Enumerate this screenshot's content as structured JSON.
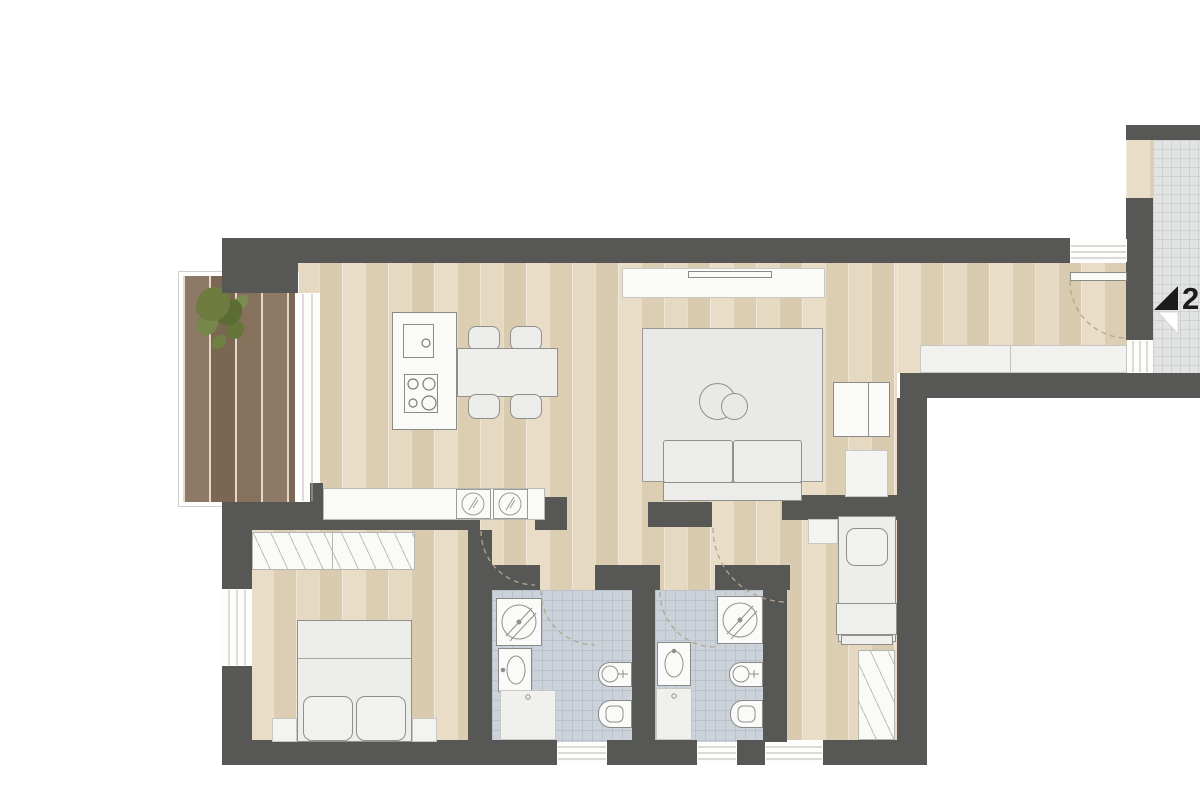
{
  "plan": {
    "type": "apartment-floor-plan",
    "marker": {
      "label": "2P"
    },
    "colors": {
      "wall": "#575756",
      "wood_floor": "#e4d7c0",
      "balcony_deck": "#85705c",
      "bathroom_tile": "#cbd2da",
      "stairwell_tile": "#e2e3e3",
      "rug": "#e9e9e7",
      "furniture_fill": "#ececea",
      "fixture_fill": "#fafaf9",
      "plant": "#6e7d3f",
      "marker_text": "#1b1b1a"
    },
    "legend": {
      "fixture_icons": [
        "plant-icon",
        "shower-icon",
        "washbasin-icon",
        "washing-machine-icon",
        "bidet-icon",
        "toilet-icon",
        "sink-icon",
        "cooktop-icon",
        "door-swing-arc",
        "entrance-arrow"
      ]
    }
  }
}
